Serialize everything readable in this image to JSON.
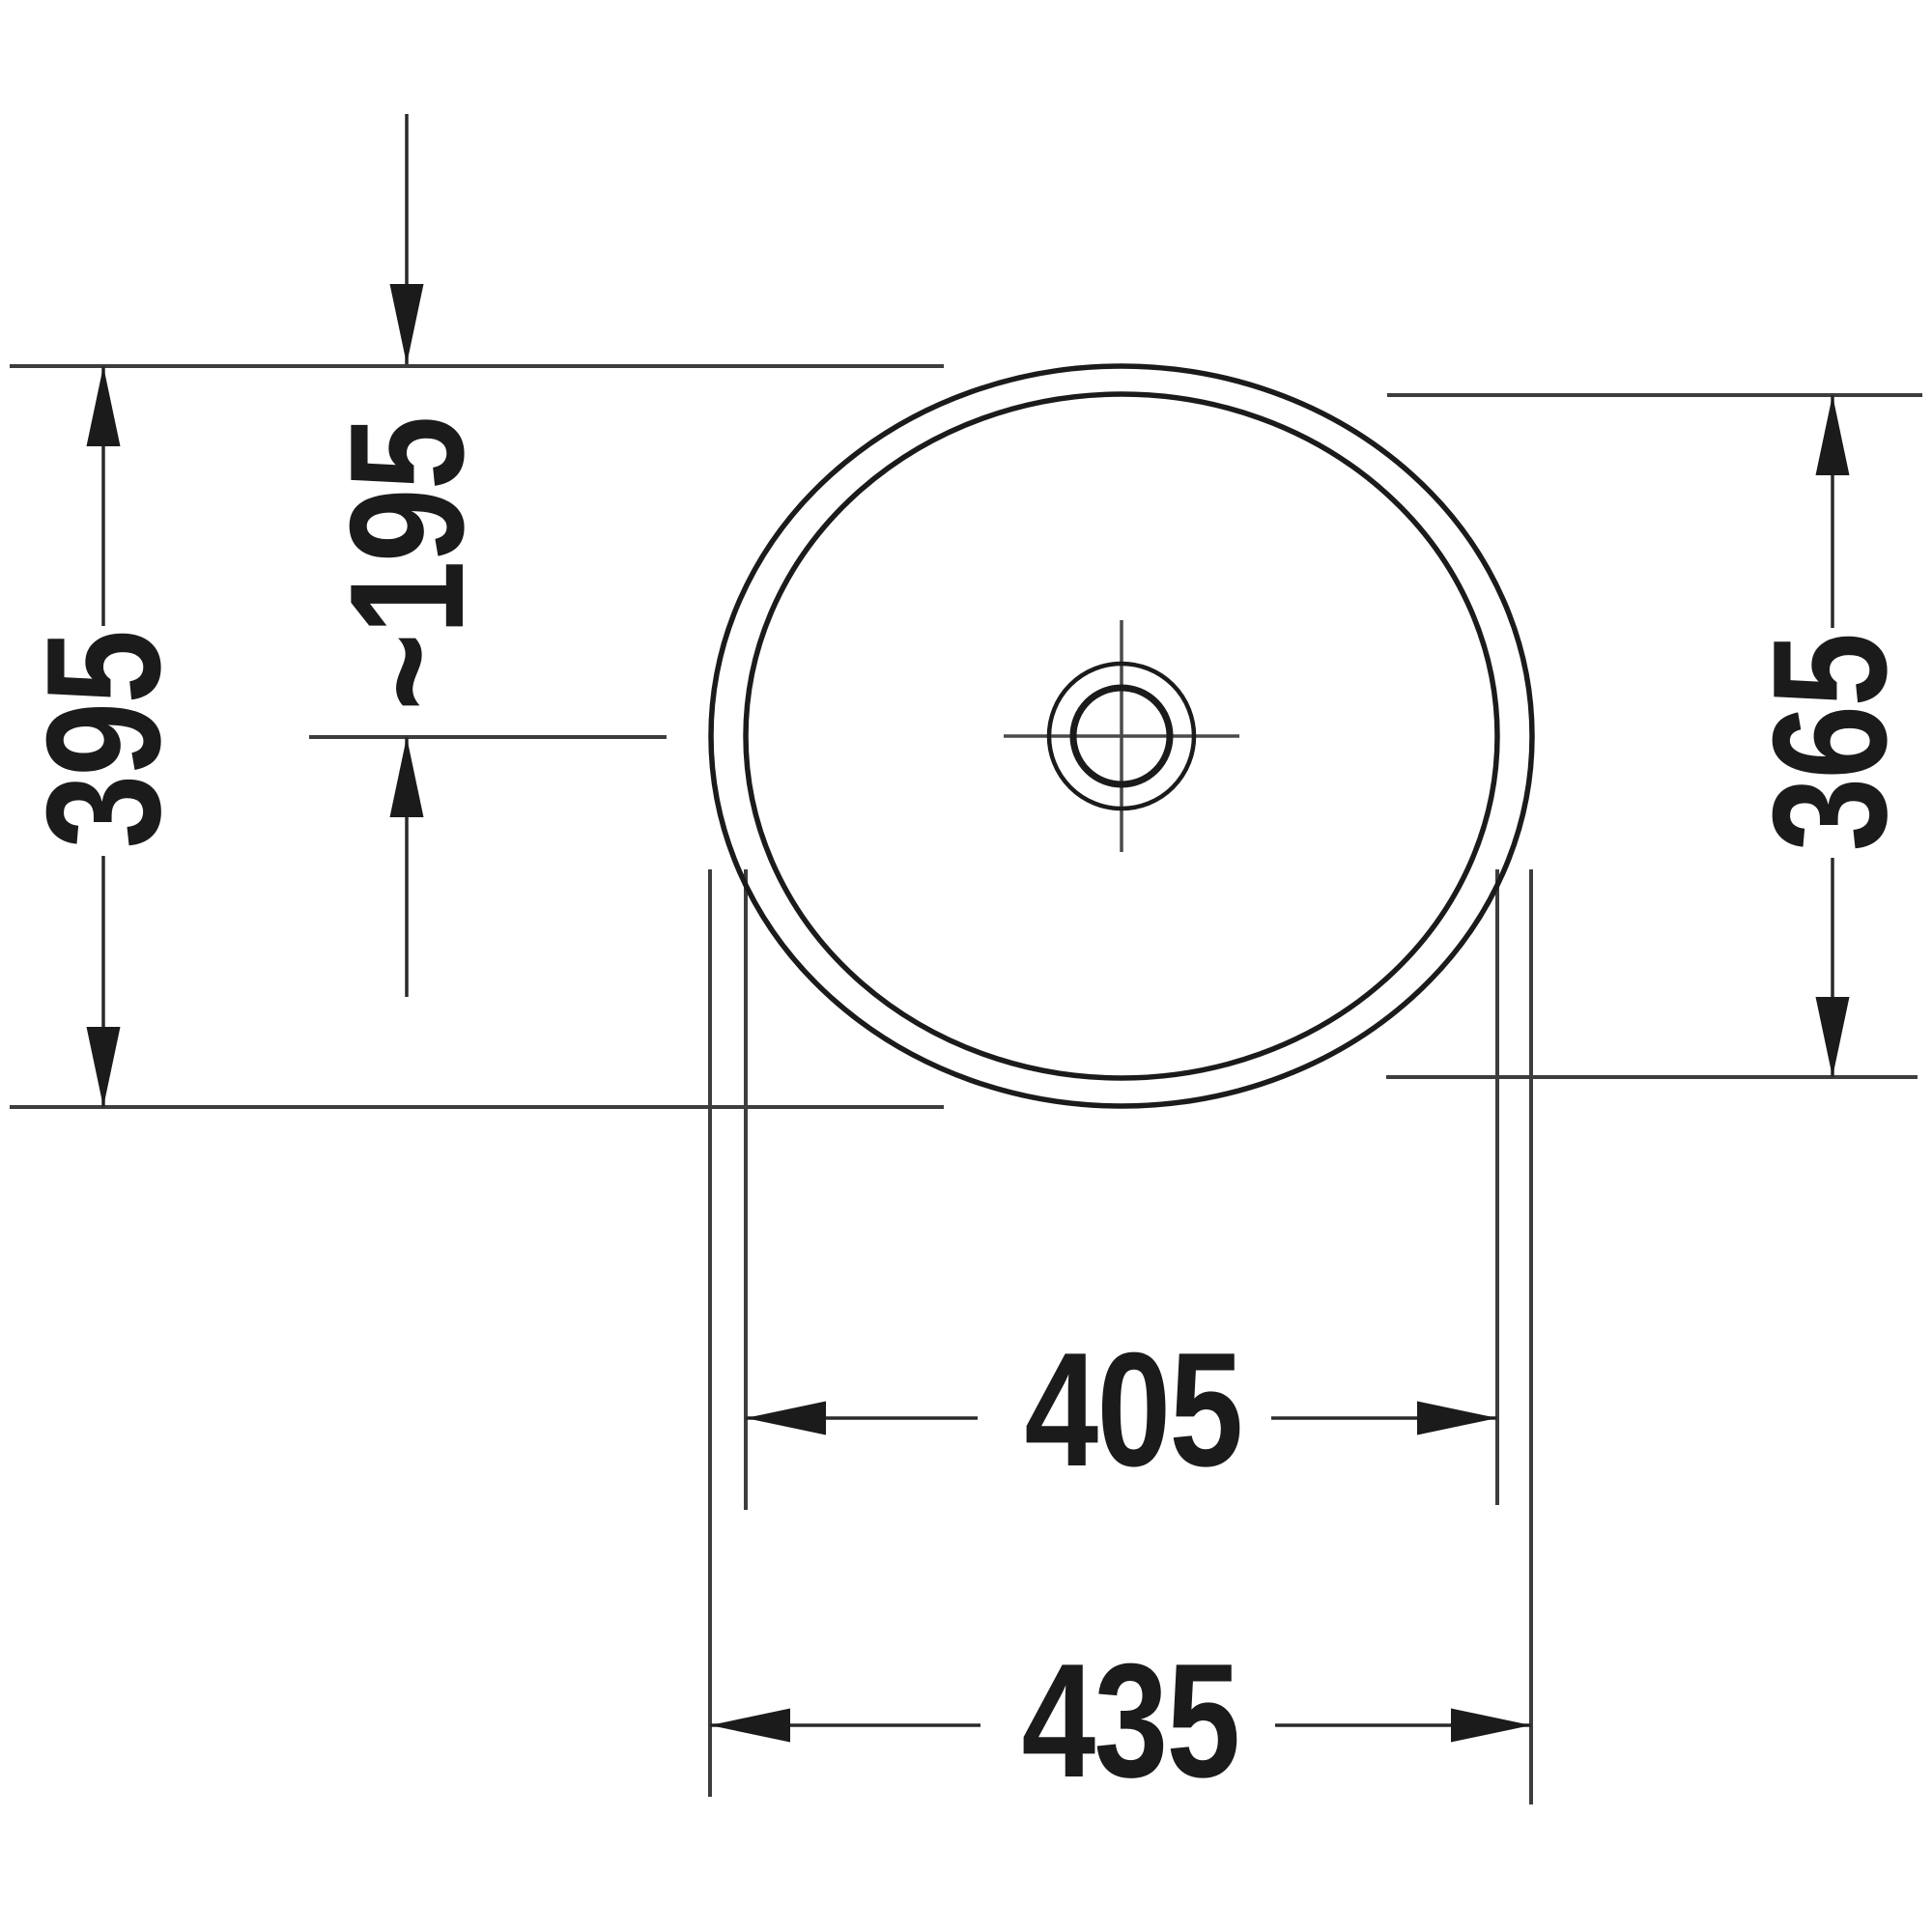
{
  "drawing": {
    "kind": "washbasin-top-view-dimension-drawing",
    "colors": {
      "background": "#ffffff",
      "outline": "#1b1b1b",
      "dimension_lines": "#3d3d3d",
      "text": "#1b1b1b"
    },
    "labels": {
      "outer_depth": "395",
      "center_offset": "~195",
      "inner_depth": "365",
      "inner_width": "405",
      "outer_width": "435"
    }
  }
}
